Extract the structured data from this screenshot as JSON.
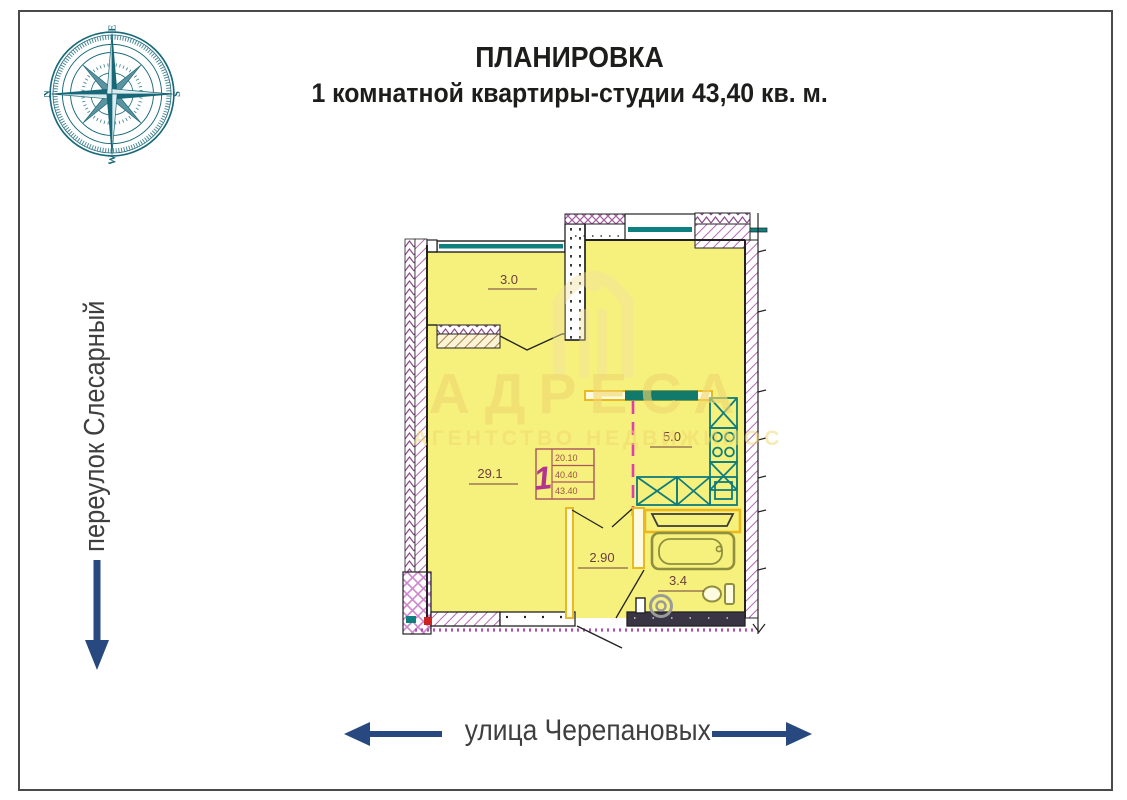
{
  "title": {
    "line1": "ПЛАНИРОВКА",
    "line2": "1 комнатной квартиры-студии 43,40 кв. м."
  },
  "streets": {
    "left": "переулок Слесарный",
    "bottom": "улица Черепановых"
  },
  "compass": {
    "north": "N",
    "east": "E",
    "south": "S",
    "west": "W"
  },
  "watermark": {
    "brand": "АДРЕСА",
    "tagline": "АГЕНТСТВО НЕДВИЖИМОС"
  },
  "plan": {
    "areas": {
      "balcony": "3.0",
      "living": "29.1",
      "kitchen": "5.0",
      "hall": "2.90",
      "bathroom": "3.4"
    },
    "stamp": {
      "rooms": "1",
      "row1": "20.10",
      "row2": "40.40",
      "row3": "43.40"
    }
  },
  "colors": {
    "arrow_navy": "#27497f",
    "window_teal": "#0e8080",
    "room_yellow": "#f6f07c",
    "wall_magenta": "#b468b4",
    "dashed_pink": "#e03fae",
    "partition_yellow": "#e9b91f",
    "label_maroon": "#6e4040",
    "compass_teal": "#176878"
  }
}
